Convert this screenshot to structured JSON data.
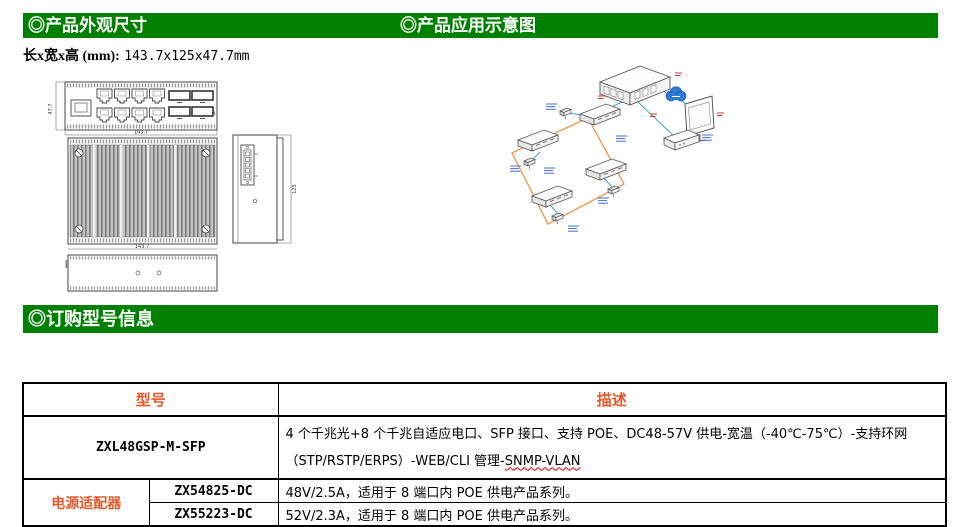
{
  "colors": {
    "header_bg": "#008000",
    "header_text": "#ffffff",
    "accent_orange": "#E25A2B",
    "diagram_blue": "#35A3DC",
    "diagram_orange": "#ED9B53",
    "cloud_blue": "#2E7BD6"
  },
  "sections": {
    "appearance_title": "◎产品外观尺寸",
    "application_title": "◎产品应用示意图",
    "ordering_title": "◎订购型号信息"
  },
  "dimensions": {
    "label": "长x宽x高 (mm):",
    "value": "143.7x125x47.7mm"
  },
  "drawings": {
    "front_width": "143.7",
    "front_height": "47.7",
    "top_width": "143.7",
    "side_depth": "125"
  },
  "table": {
    "header_model": "型号",
    "header_desc": "描述",
    "product": {
      "model": "ZXL48GSP-M-SFP",
      "desc_line1": "4 个千兆光+8 个千兆自适应电口、SFP 接口、支持 POE、DC48-57V 供电-宽温（-40℃-75℃）-支持环网",
      "desc_line2_prefix": "（STP/RSTP/ERPS）-WEB/CLI 管理-",
      "desc_line2_flagged": "SNMP-VLAN"
    },
    "adapter_label": "电源适配器",
    "adapters": [
      {
        "model": "ZX54825-DC",
        "desc": "48V/2.5A，适用于 8 端口内 POE 供电产品系列。"
      },
      {
        "model": "ZX55223-DC",
        "desc": "52V/2.3A，适用于 8 端口内 POE 供电产品系列。"
      }
    ]
  }
}
